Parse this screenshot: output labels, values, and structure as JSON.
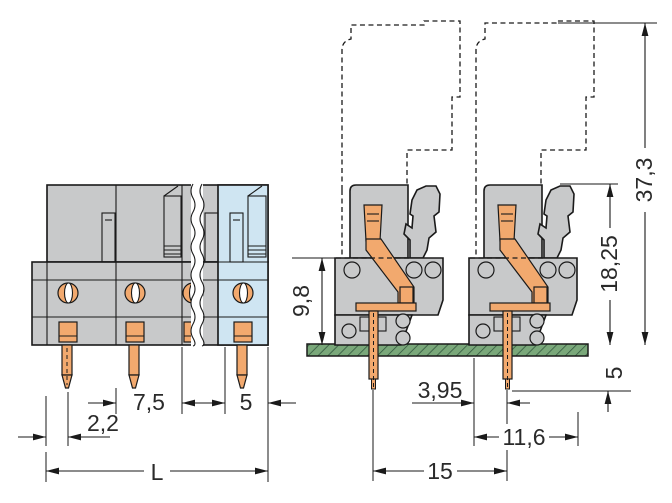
{
  "figure": {
    "kind": "connector-dimension-drawing",
    "views": {
      "left": "front-view",
      "right": "side-view-on-pcb"
    }
  },
  "colors": {
    "housing_gray": "#c8c9ca",
    "variant_blue": "#cfe5f2",
    "contact_orange": "#f2a96e",
    "pcb_green": "#7aa87a",
    "pcb_hatch": "#33573f",
    "line": "#1a1a1a"
  },
  "dims": {
    "front": {
      "pitch": "7,5",
      "pitch_small": "5",
      "edge_offset": "2,2",
      "total_length": "L"
    },
    "side": {
      "total_height": "37,3",
      "body_height": "18,25",
      "front_height": "9,8",
      "pin_below_board": "5",
      "pin_to_edge": "3,95",
      "body_depth": "11,6",
      "pin_spacing": "15"
    }
  }
}
